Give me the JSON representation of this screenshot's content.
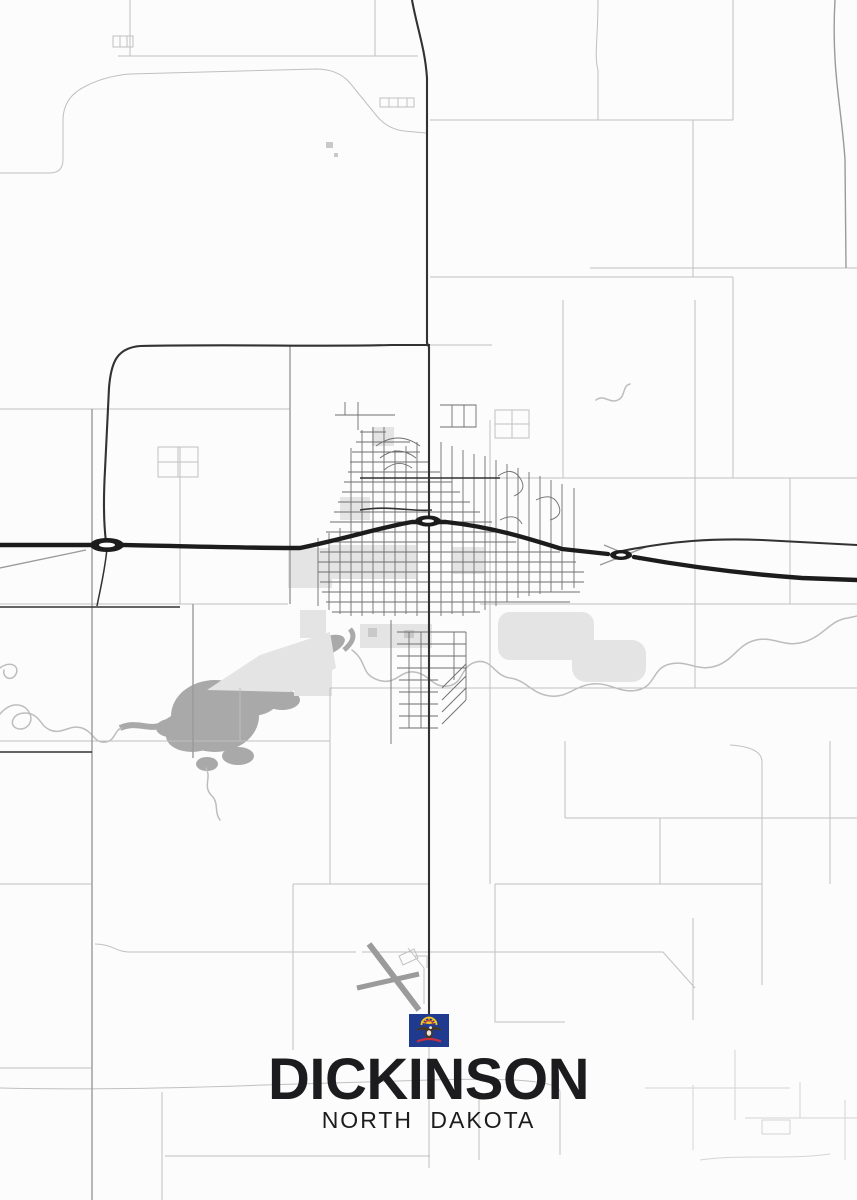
{
  "poster": {
    "city": "DICKINSON",
    "state": "NORTH DAKOTA"
  },
  "flag": {
    "name": "north-dakota-flag"
  },
  "map": {
    "features": [
      "interstate",
      "highway",
      "section-roads",
      "city-street-grid",
      "lake",
      "river",
      "ponds",
      "airport-runways"
    ]
  },
  "theme": {
    "background": "#fcfcfc",
    "road-faint": "#c0c0c0",
    "road-medium": "#9a9a9a",
    "road-city": "#6e6e6e",
    "road-dark": "#323232",
    "interstate": "#1c1c1c",
    "runway": "#9b9b9b",
    "water": "#a9a9a9",
    "water-line": "#bdbdbd",
    "area": "#e4e4e4",
    "area-dark": "#c9c9c9",
    "text": "#1c1c1e",
    "flag-field": "#203a8f",
    "flag-gold": "#f5c41e",
    "flag-eagle": "#453728",
    "flag-ribbon": "#c9303e",
    "flag-white": "#ece8df"
  }
}
